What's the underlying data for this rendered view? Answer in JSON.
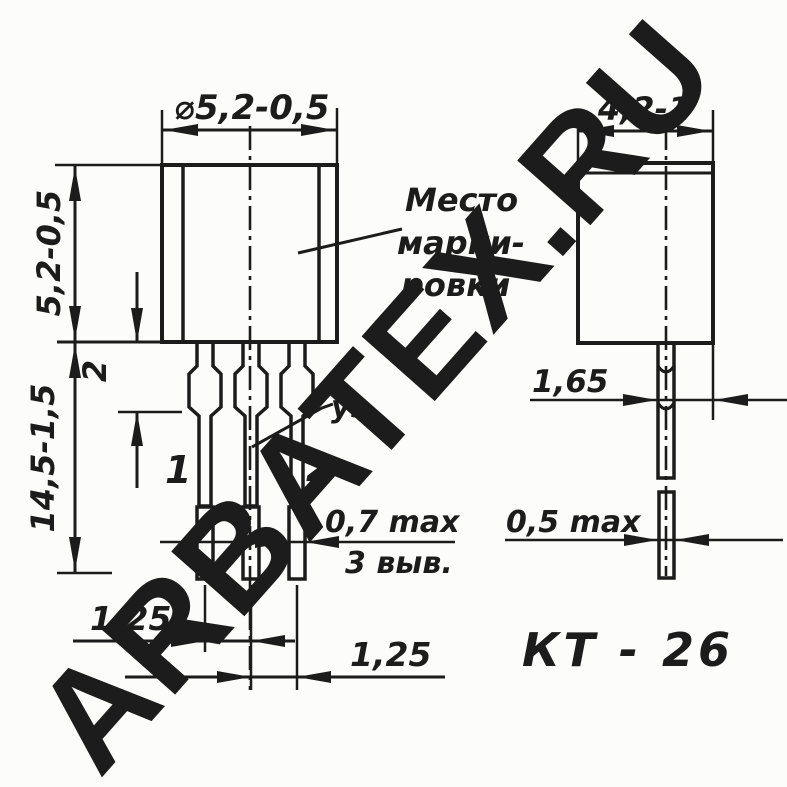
{
  "watermark": {
    "text": "ARBATEX.RU",
    "color_light": "#f7bdb8",
    "color_mid": "#f2a5a0",
    "color_dark": "#e06a62"
  },
  "package": {
    "name": "КТ - 26"
  },
  "front_view": {
    "diameter_dim": "⌀5,2-0,5",
    "body_height_dim": "5,2-0,5",
    "lead_length_dim": "14,5-1,5",
    "shoulder_length_dim": "2",
    "lead_pitch_dim_left": "1,25",
    "lead_pitch_dim_right": "1,25",
    "lead_tip_thickness_dim": "0,7 max",
    "leads_count_note": "3 выв.",
    "lead_1_label": "1",
    "lead_2_label": "2",
    "gate_lead_label": "уэ",
    "marking_area_label": [
      "Место",
      "марки-",
      "ровки"
    ]
  },
  "side_view": {
    "body_width_dim": "4,2-1",
    "lead_offset_dim": "1,65",
    "lead_tip_thickness_dim": "0,5 max"
  },
  "colors": {
    "line": "#1c1c1c",
    "background": "#fcfcfa"
  }
}
